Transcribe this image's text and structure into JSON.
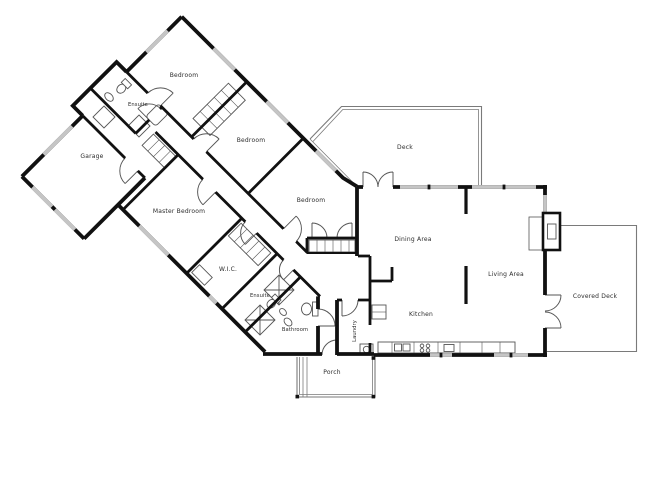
{
  "document": {
    "type": "architectural-floor-plan",
    "background": "#ffffff"
  },
  "palette": {
    "wall": "#111111",
    "window": "#c5c5c5",
    "thin_line": "#555555",
    "deck_line": "#7a7a7a",
    "label": "#2b2b2b"
  },
  "rooms": {
    "bedroom_top": {
      "label": "Bedroom"
    },
    "ensuite_top": {
      "label": "Ensuite"
    },
    "garage": {
      "label": "Garage"
    },
    "master_bedroom": {
      "label": "Master Bedroom"
    },
    "bedroom_mid": {
      "label": "Bedroom"
    },
    "bedroom_right": {
      "label": "Bedroom"
    },
    "deck": {
      "label": "Deck"
    },
    "dining": {
      "label": "Dining Area"
    },
    "living": {
      "label": "Living Area"
    },
    "covered_deck": {
      "label": "Covered Deck"
    },
    "kitchen": {
      "label": "Kitchen"
    },
    "wic": {
      "label": "W.I.C."
    },
    "ensuite_lower": {
      "label": "Ensuite"
    },
    "bathroom": {
      "label": "Bathroom"
    },
    "laundry": {
      "label": "Laundry"
    },
    "porch": {
      "label": "Porch"
    }
  }
}
